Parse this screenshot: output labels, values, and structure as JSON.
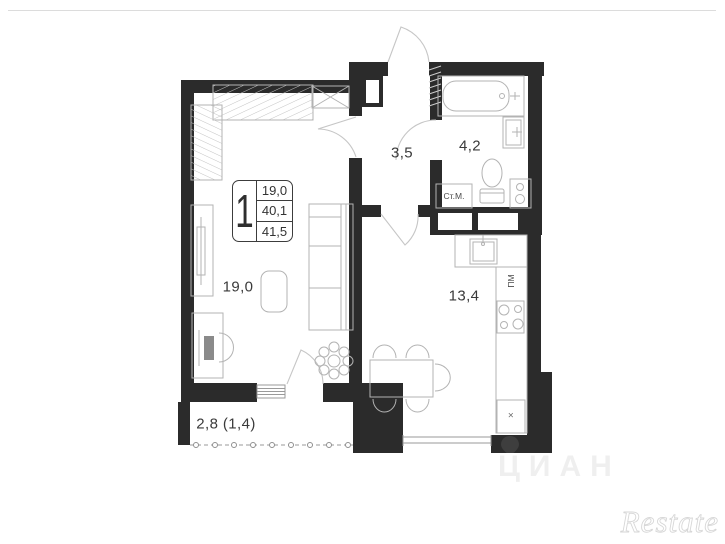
{
  "legend": {
    "rooms_count": "1",
    "values": [
      "19,0",
      "40,1",
      "41,5"
    ]
  },
  "labels": {
    "living_room": "19,0",
    "hallway": "3,5",
    "bathroom": "4,2",
    "kitchen": "13,4",
    "balcony": "2,8 (1,4)"
  },
  "appliances": {
    "washing_machine": "Ст.М.",
    "dishwasher": "ПМ",
    "fridge_mark": "×"
  },
  "watermarks": {
    "brand": "Restate",
    "portal": "ЦИАН"
  },
  "colors": {
    "wall": "#2b2b2b",
    "furniture_line": "#b3b3b3",
    "door_arc": "#c6c6c6",
    "label_text": "#3a3a3a"
  }
}
